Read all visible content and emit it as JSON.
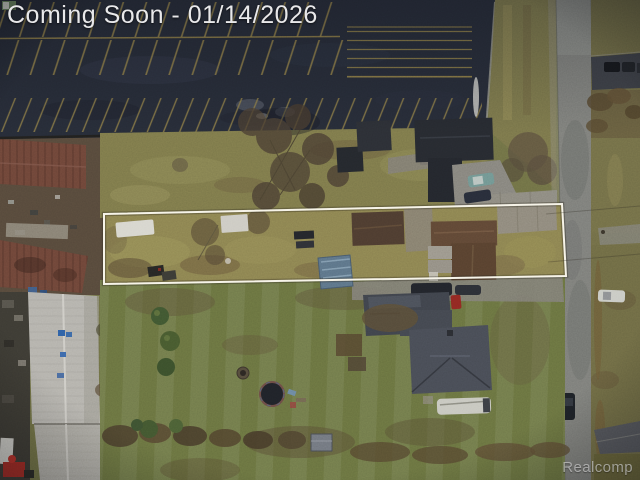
{
  "overlay": {
    "coming_soon_label": "Coming Soon - 01/14/2026",
    "watermark_label": "Realcomp"
  },
  "listing": {
    "status": "Coming Soon",
    "date": "01/14/2026"
  },
  "colors": {
    "asphalt": "#262b36",
    "stripe_yellow": "#8f7e45",
    "grass_base": "#6e6f44",
    "grass_north": "#7b7749",
    "grass_south": "#68713f",
    "property_grass": "#8a814f",
    "road_gray": "#7b7c78",
    "concrete": "#84817a",
    "boundary_white": "#f6f3e7",
    "rust_roof": "#6c4437",
    "white_building": "#b3b1ab",
    "roof_brown": "#5e4634",
    "roof_slate": "#474b54",
    "tarp_blue": "#5b7286",
    "overlay_text": "#e8e8ea",
    "watermark_text": "#d8d8d8"
  },
  "scene": {
    "regions": [
      "parking-lot",
      "subject-property-boundary",
      "north-lawn",
      "residential-street",
      "south-yard",
      "industrial-buildings"
    ]
  }
}
